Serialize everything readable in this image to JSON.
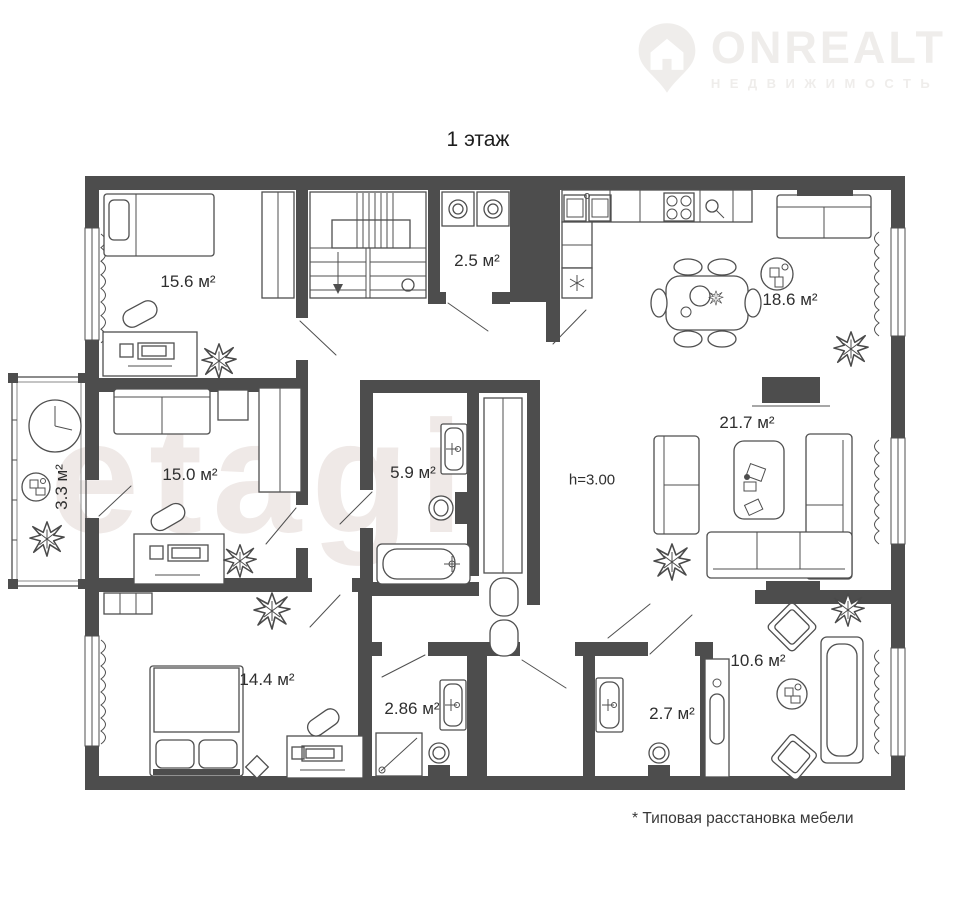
{
  "logo": {
    "brand": "ONREALT",
    "tagline": "НЕДВИЖИМОСТЬ"
  },
  "title": "1 этаж",
  "watermark": "etagi",
  "footnote": "* Типовая расстановка мебели",
  "plan": {
    "ceiling_height": "h=3.00",
    "rooms": [
      {
        "name": "bedroom-1",
        "label": "15.6 м²"
      },
      {
        "name": "laundry",
        "label": "2.5 м²"
      },
      {
        "name": "kitchen-dining",
        "label": "18.6 м²"
      },
      {
        "name": "living-room",
        "label": "21.7 м²"
      },
      {
        "name": "bedroom-2",
        "label": "15.0 м²"
      },
      {
        "name": "balcony",
        "label": "3.3 м²"
      },
      {
        "name": "bathroom",
        "label": "5.9 м²"
      },
      {
        "name": "bedroom-3",
        "label": "14.4 м²"
      },
      {
        "name": "shower-room",
        "label": "2.86 м²"
      },
      {
        "name": "wc",
        "label": "2.7 м²"
      },
      {
        "name": "sunroom",
        "label": "10.6 м²"
      }
    ]
  },
  "colors": {
    "wall": "#4d4d4d",
    "line": "#4f4f4f",
    "label_text": "#2f2f2f",
    "watermark": "#efe9e7",
    "logo": "#efedeb"
  }
}
